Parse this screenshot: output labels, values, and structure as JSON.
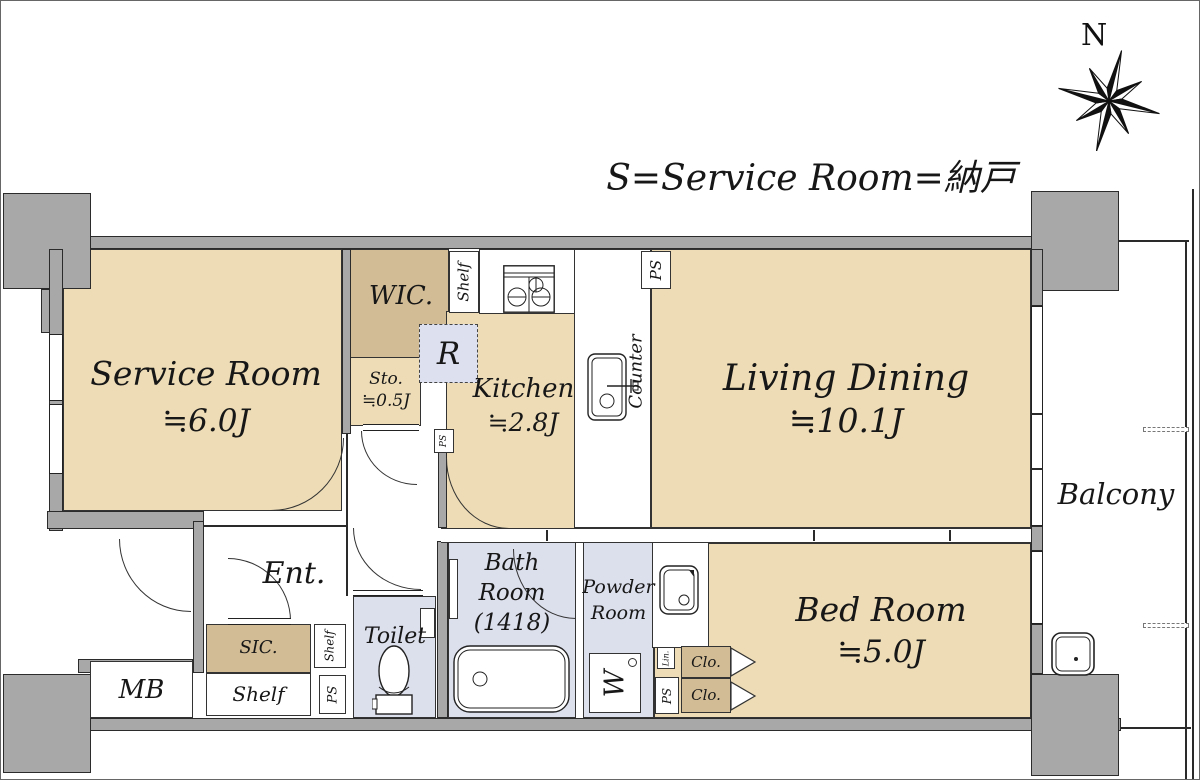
{
  "header": {
    "legend": "S=Service Room=納戸"
  },
  "compass": {
    "north_label": "N"
  },
  "rooms": {
    "service": {
      "name": "Service Room",
      "area": "≒6.0J"
    },
    "wic": {
      "name": "WIC."
    },
    "sto": {
      "name": "Sto.",
      "area": "≒0.5J"
    },
    "kitchen": {
      "name": "Kitchen",
      "area": "≒2.8J"
    },
    "living_dining": {
      "name": "Living Dining",
      "area": "≒10.1J"
    },
    "balcony": {
      "name": "Balcony"
    },
    "bedroom": {
      "name": "Bed Room",
      "area": "≒5.0J"
    },
    "bath": {
      "line1": "Bath",
      "line2": "Room",
      "line3": "(1418)"
    },
    "powder": {
      "line1": "Powder",
      "line2": "Room"
    },
    "toilet": {
      "name": "Toilet"
    },
    "entrance": {
      "name": "Ent."
    },
    "sic": {
      "name": "SIC."
    },
    "mb": {
      "name": "MB"
    }
  },
  "fixtures": {
    "refrigerator": "R",
    "washer": "W",
    "counter": "Counter",
    "kitchen_shelf": "Shelf",
    "entry_shelf_side": "Shelf",
    "entry_shelf_bottom": "Shelf",
    "linen": "Lin.",
    "closet_upper": "Clo.",
    "closet_lower": "Clo.",
    "ps_kitchen": "PS",
    "ps_hall": "PS",
    "ps_entry": "PS",
    "ps_powder": "PS"
  },
  "colors": {
    "floor_beige": "#eddcb6",
    "closet_tan": "#d2bc95",
    "wet_area_blue": "#dcdfec",
    "wall_gray": "#a8a8a8",
    "line_black": "#2a2a2a"
  }
}
